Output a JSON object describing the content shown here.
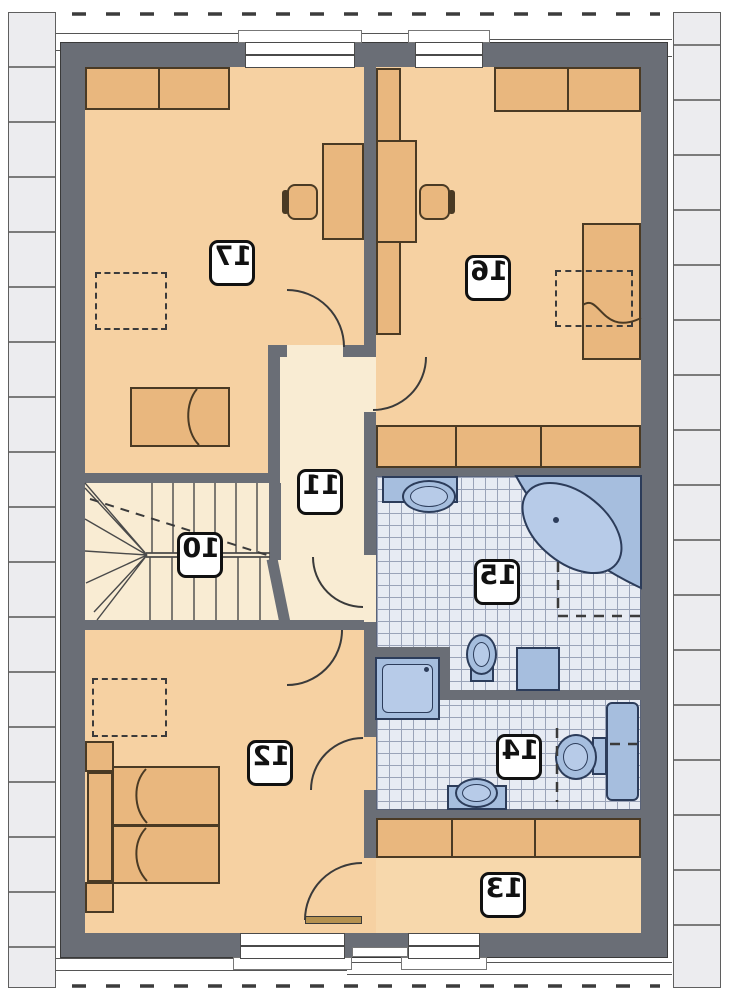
{
  "meta": {
    "drawing_type": "floor-plan",
    "labels_mirrored": true
  },
  "rooms": {
    "r10": {
      "label": "10"
    },
    "r11": {
      "label": "11"
    },
    "r12": {
      "label": "12"
    },
    "r13": {
      "label": "13"
    },
    "r14": {
      "label": "14"
    },
    "r15": {
      "label": "15"
    },
    "r16": {
      "label": "16"
    },
    "r17": {
      "label": "17"
    }
  },
  "colors": {
    "wall": "#6a6e76",
    "floor_warm": "#f6d1a2",
    "floor_light": "#f9ecd3",
    "floor_13": "#f7d8ac",
    "tile_bg": "#e7ebf3",
    "tile_line": "#9aa3b8",
    "fixture": "#a6bede",
    "fixture_border": "#2c3c5a",
    "furniture": "#e9b77e",
    "furniture_border": "#4a3a24"
  }
}
